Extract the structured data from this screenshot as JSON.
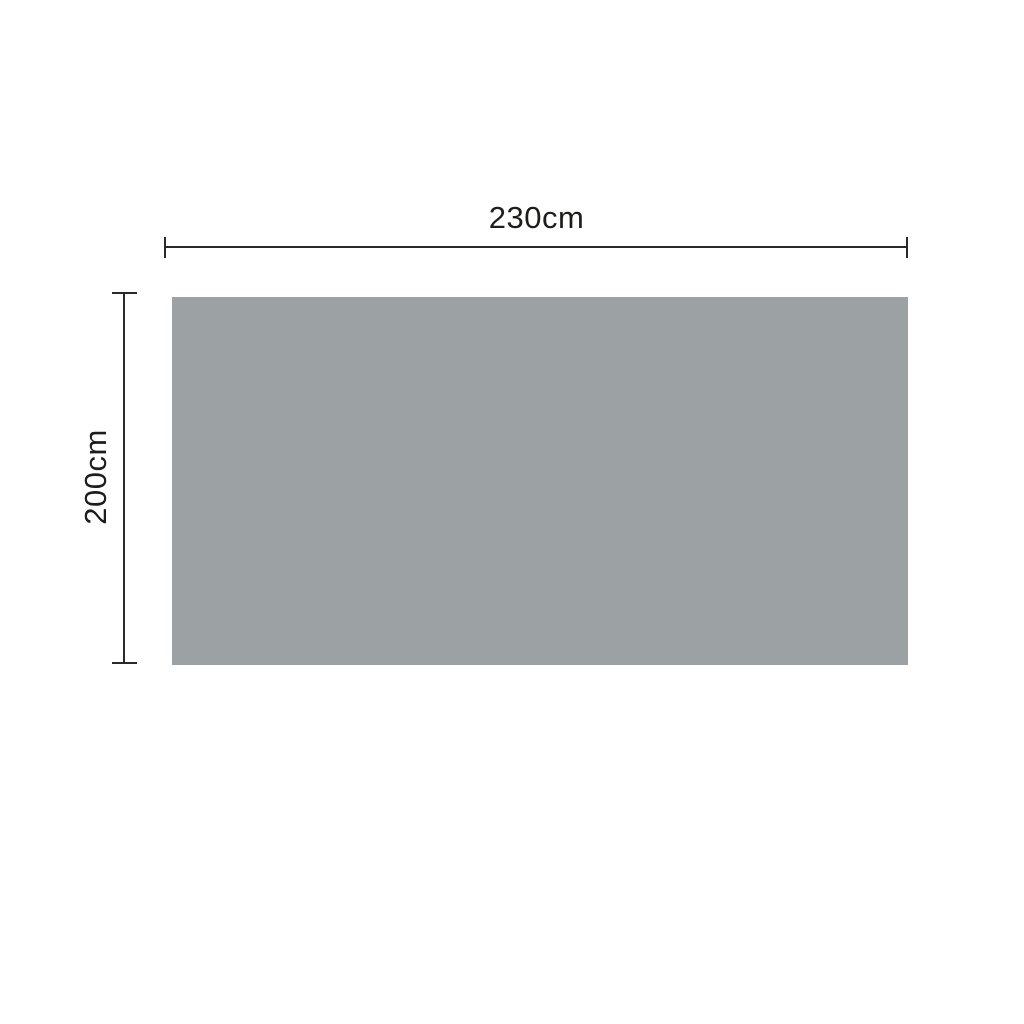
{
  "diagram": {
    "type": "product-dimension-diagram",
    "shape": "rectangle",
    "width_label": "230cm",
    "height_label": "200cm",
    "width_value_cm": 230,
    "height_value_cm": 200
  },
  "colors": {
    "background": "#ffffff",
    "rect_fill": "#9ca1a4",
    "line_color": "#2a2a2a",
    "text_color": "#1d1d1b"
  }
}
